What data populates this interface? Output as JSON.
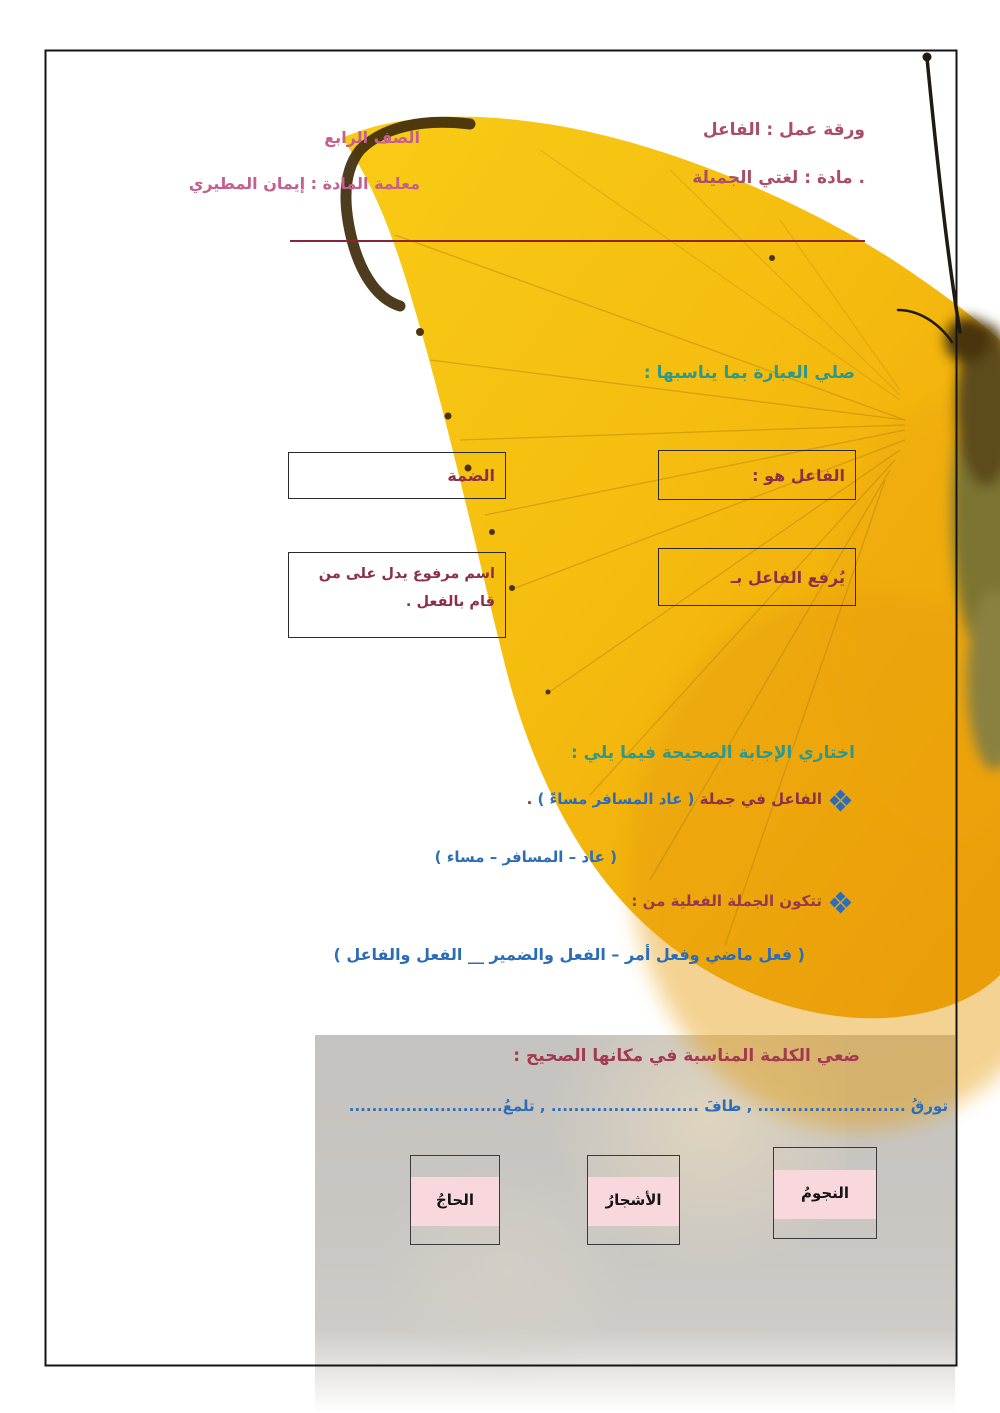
{
  "header": {
    "title_line": "ورقة عمل : الفاعل",
    "subject_line": ". مادة : لغتي الجميلة",
    "grade_line": "الصف الرابع",
    "teacher_line": "معلمة المادة : إيمان المطيري"
  },
  "match_section": {
    "title": "صلي العبارة بما يناسبها :",
    "right_boxes": [
      "الفاعل هو :",
      "يُرفع الفاعل بـ"
    ],
    "left_boxes": [
      "الضمة",
      "اسم مرفوع يدل على من قام بالفعل ."
    ]
  },
  "choose_section": {
    "title": "اختاري الإجابة الصحيحة فيما يلي :",
    "q1_prefix": "الفاعل في جملة ",
    "q1_highlight": "( عاد المسافر مساءً )",
    "q1_suffix": " .",
    "q1_options": "( عاد – المسافر – مساء )",
    "q2_text": "تتكون الجملة الفعلية من :",
    "q2_options": "( فعل ماضي وفعل أمر – الفعل والضمير __ الفعل والفاعل )"
  },
  "fill_section": {
    "title": "ضعي الكلمة المناسبة في مكانها الصحيح :",
    "line": "تورقُ .......................... , طافَ .......................... , تلمعُ...........................",
    "words": [
      "النجومُ",
      "الأشجارُ",
      "الحاجُ"
    ]
  },
  "colors": {
    "teal": "#2d998c",
    "blue": "#2c6db5",
    "maroon": "#8c3048",
    "header_rose": "#aa4e68",
    "header_pink": "#c45f8e",
    "pink_band": "#f8d7dd",
    "wing_yellow": "#f5bd0f"
  }
}
